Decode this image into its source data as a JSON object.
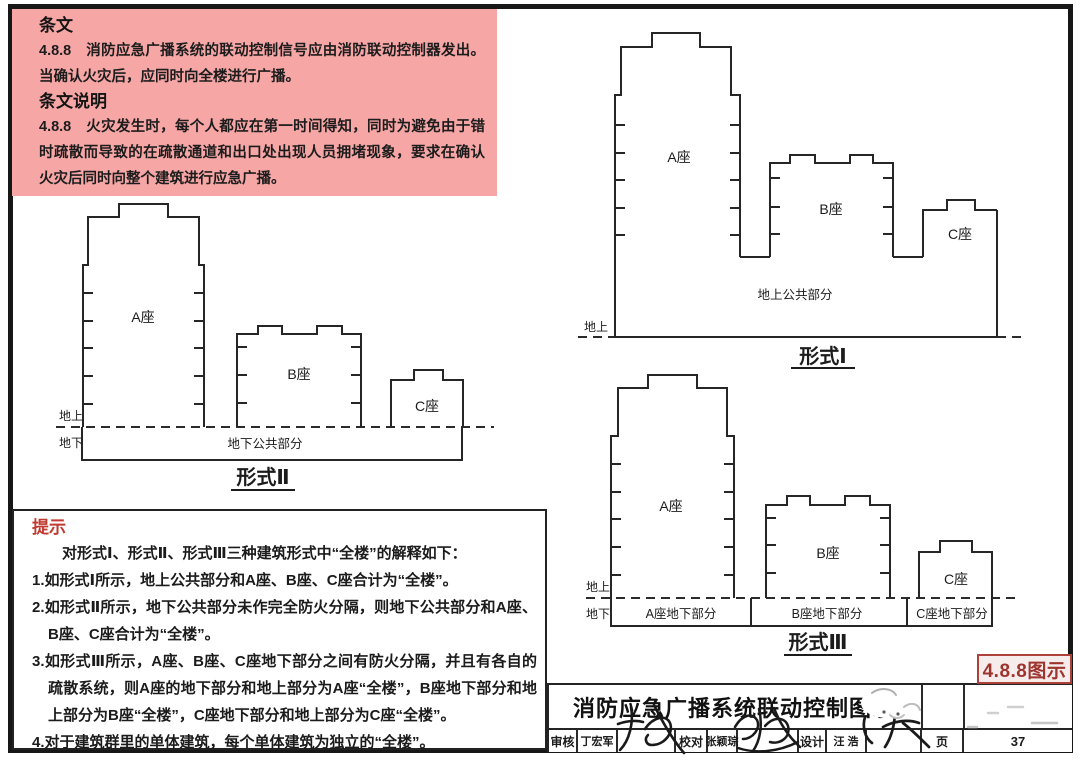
{
  "provision_box": {
    "heading1": "条文",
    "para1": "4.8.8　消防应急广播系统的联动控制信号应由消防联动控制器发出。当确认火灾后，应同时向全楼进行广播。",
    "heading2": "条文说明",
    "para2": "4.8.8　火灾发生时，每个人都应在第一时间得知，同时为避免由于错时疏散而导致的在疏散通道和出口处出现人员拥堵现象，要求在确认火灾后同时向整个建筑进行应急广播。"
  },
  "tip_box": {
    "heading": "提示",
    "intro": "对形式Ⅰ、形式Ⅱ、形式Ⅲ三种建筑形式中“全楼”的解释如下：",
    "items": [
      "1.如形式Ⅰ所示，地上公共部分和A座、B座、C座合计为“全楼”。",
      "2.如形式Ⅱ所示，地下公共部分未作完全防火分隔，则地下公共部分和A座、B座、C座合计为“全楼”。",
      "3.如形式Ⅲ所示，A座、B座、C座地下部分之间有防火分隔，并且有各自的疏散系统，则A座的地下部分和地上部分为A座“全楼”，B座地下部分和地上部分为B座“全楼”，C座地下部分和地上部分为C座“全楼”。",
      "4.对于建筑群里的单体建筑，每个单体建筑为独立的“全楼”。"
    ]
  },
  "diagrams": {
    "form1": {
      "tower_a": "A座",
      "tower_b": "B座",
      "tower_c": "C座",
      "podium": "地上公共部分",
      "above": "地上",
      "title": "形式Ⅰ"
    },
    "form2": {
      "tower_a": "A座",
      "tower_b": "B座",
      "tower_c": "C座",
      "basement": "地下公共部分",
      "above": "地上",
      "below": "地下",
      "title": "形式Ⅱ"
    },
    "form3": {
      "tower_a": "A座",
      "tower_b": "B座",
      "tower_c": "C座",
      "basement_a": "A座地下部分",
      "basement_b": "B座地下部分",
      "basement_c": "C座地下部分",
      "above": "地上",
      "below": "地下",
      "title": "形式Ⅲ"
    }
  },
  "figure_tag": "4.8.8图示",
  "title_block": {
    "title": "消防应急广播系统联动控制图示",
    "review_label": "审核",
    "reviewer": "丁宏军",
    "reviewer_signature": "丁宏军",
    "proof_label": "校对",
    "proofreader": "张颖琮",
    "proofreader_signature": "张颖琮",
    "design_label": "设计",
    "designer": "汪 浩",
    "designer_signature": "汪浩",
    "page_label": "页",
    "page_number": "37"
  },
  "colors": {
    "provision_pink": "#F7A6A6",
    "tip_red": "#C13A30",
    "figure_tag_red": "#AD4038",
    "line_black": "#262626"
  }
}
